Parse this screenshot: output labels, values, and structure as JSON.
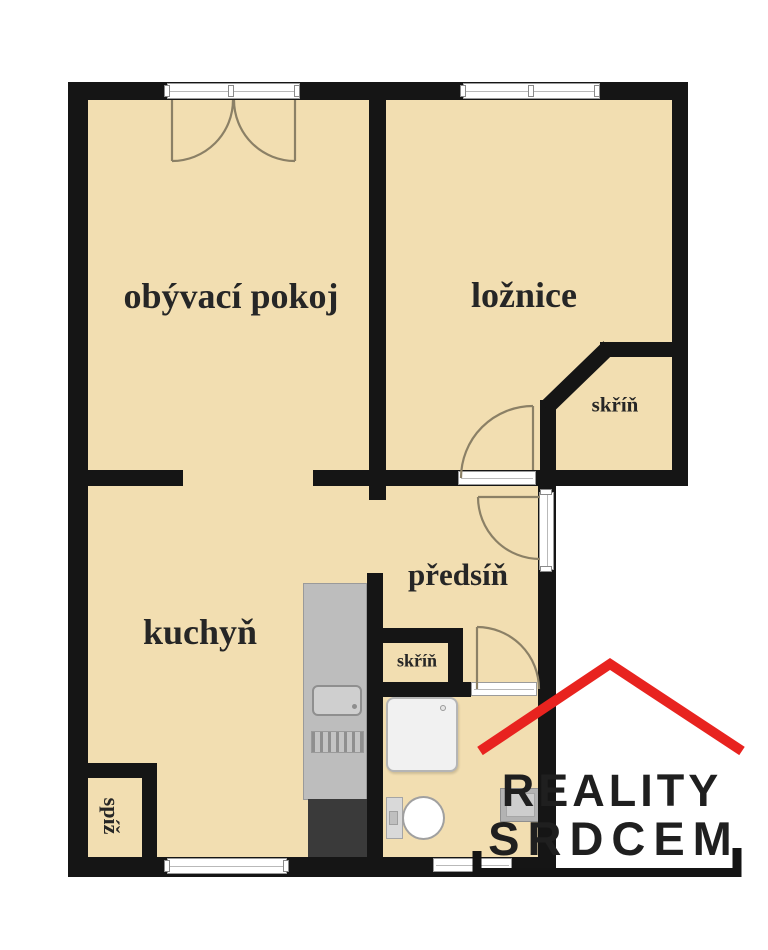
{
  "plan": {
    "type": "apartment-floor-plan",
    "rooms": {
      "living": "obývací pokoj",
      "bedroom": "ložnice",
      "bedroom_wardrobe": "skříň",
      "hallway": "předsíň",
      "kitchen": "kuchyň",
      "hall_wardrobe": "skříň",
      "pantry": "spíž"
    },
    "fixtures": [
      "kitchen-counter",
      "stove",
      "sink",
      "fridge",
      "shower",
      "toilet",
      "washbasin"
    ],
    "openings": [
      "balcony-double-door",
      "bedroom-window",
      "kitchen-window",
      "bathroom-window",
      "entrance-door",
      "bedroom-door",
      "bathroom-door"
    ]
  },
  "logo": {
    "line1": "REALITY",
    "line2": "SRDCEM"
  },
  "colors": {
    "floor": "#f2deb1",
    "wall": "#151515",
    "roof_red": "#e8231f",
    "logo_text": "#1f1f1f",
    "door_arc": "#8b8066"
  }
}
